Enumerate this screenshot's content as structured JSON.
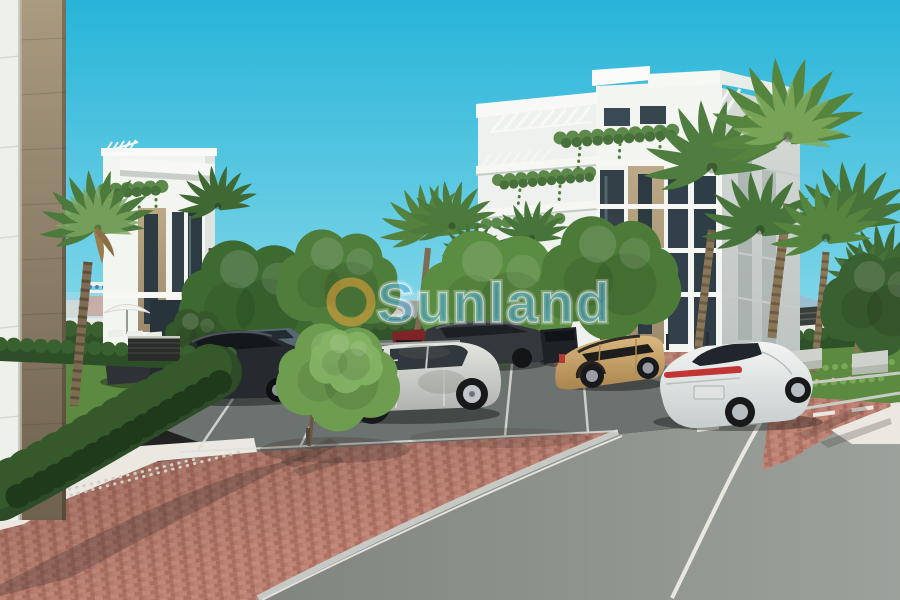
{
  "watermark": {
    "text": "Sunland"
  },
  "scene": {
    "type": "3d-architectural-rendering",
    "setting": "Modern white apartment complex exterior with palm trees, landscaped garden, brick-paved parking area and curving asphalt road under a bright turquoise sky",
    "objects": [
      "left white apartment building with roof pergola and hanging plants",
      "right white apartment building with stepped terraces, pergolas and beige stone strip",
      "foreground corner wall with stone pillar",
      "fan palm trees",
      "green deciduous trees and hedges",
      "garden with white parasol, sun loungers and dark slatted planter box",
      "red brick herringbone paving",
      "asphalt parking bays with white lines",
      "curving road with white edge and dashed lane lines",
      "white gravel strips",
      "distant cityscape, sea band and hazy mountains",
      "Sunland watermark with orange ring"
    ],
    "cars": [
      {
        "color": "dark gray",
        "type": "sedan",
        "position": "far left behind hedge"
      },
      {
        "color": "black",
        "type": "sedan",
        "position": "left parking row"
      },
      {
        "color": "blue gray",
        "type": "suv",
        "position": "behind left trees"
      },
      {
        "color": "dark red",
        "type": "suv",
        "position": "back row, behind silver suv"
      },
      {
        "color": "dark gray",
        "type": "suv",
        "position": "back row center"
      },
      {
        "color": "black",
        "type": "suv",
        "position": "back row right"
      },
      {
        "color": "silver",
        "type": "suv",
        "position": "center foreground parking bay"
      },
      {
        "color": "tan",
        "type": "compact suv",
        "position": "center right bay"
      },
      {
        "color": "white",
        "type": "fastback sedan",
        "position": "right foreground"
      },
      {
        "color": "silver",
        "type": "car",
        "position": "distant road behind hedge"
      }
    ]
  },
  "palette": {
    "sky_top": "#27b4d8",
    "sky_low": "#9ee2ee",
    "haze": "#bfd3da",
    "sea": "#cfe3e9",
    "wall_white": "#eef0ec",
    "building_white": "#f3f5f1",
    "window_dark": "#334047",
    "stone": "#9a8a6f",
    "plant_green": "#5d8a4a",
    "hedge_dark": "#2c4b26",
    "tree_green": "#4f7d3c",
    "palm_green": "#4f7d3f",
    "trunk": "#7d6b52",
    "grass": "#5d8a41",
    "brick": "#b97f71",
    "parking_asphalt": "#6c7270",
    "road_asphalt": "#949894",
    "gravel": "#eae8e1",
    "curb": "#c6c9c4",
    "line_white": "#e9e7df",
    "fence_dark": "#3a3e3a",
    "car_black": "#26292d",
    "car_dark": "#34383c",
    "car_silver": "#c9ccc8",
    "car_tan": "#c7a26b",
    "car_white": "#eaeded",
    "car_red": "#7e2427",
    "tail_red": "#c23535",
    "watermark_ring": "#efa63b",
    "watermark_text": "#4fa8d4"
  }
}
